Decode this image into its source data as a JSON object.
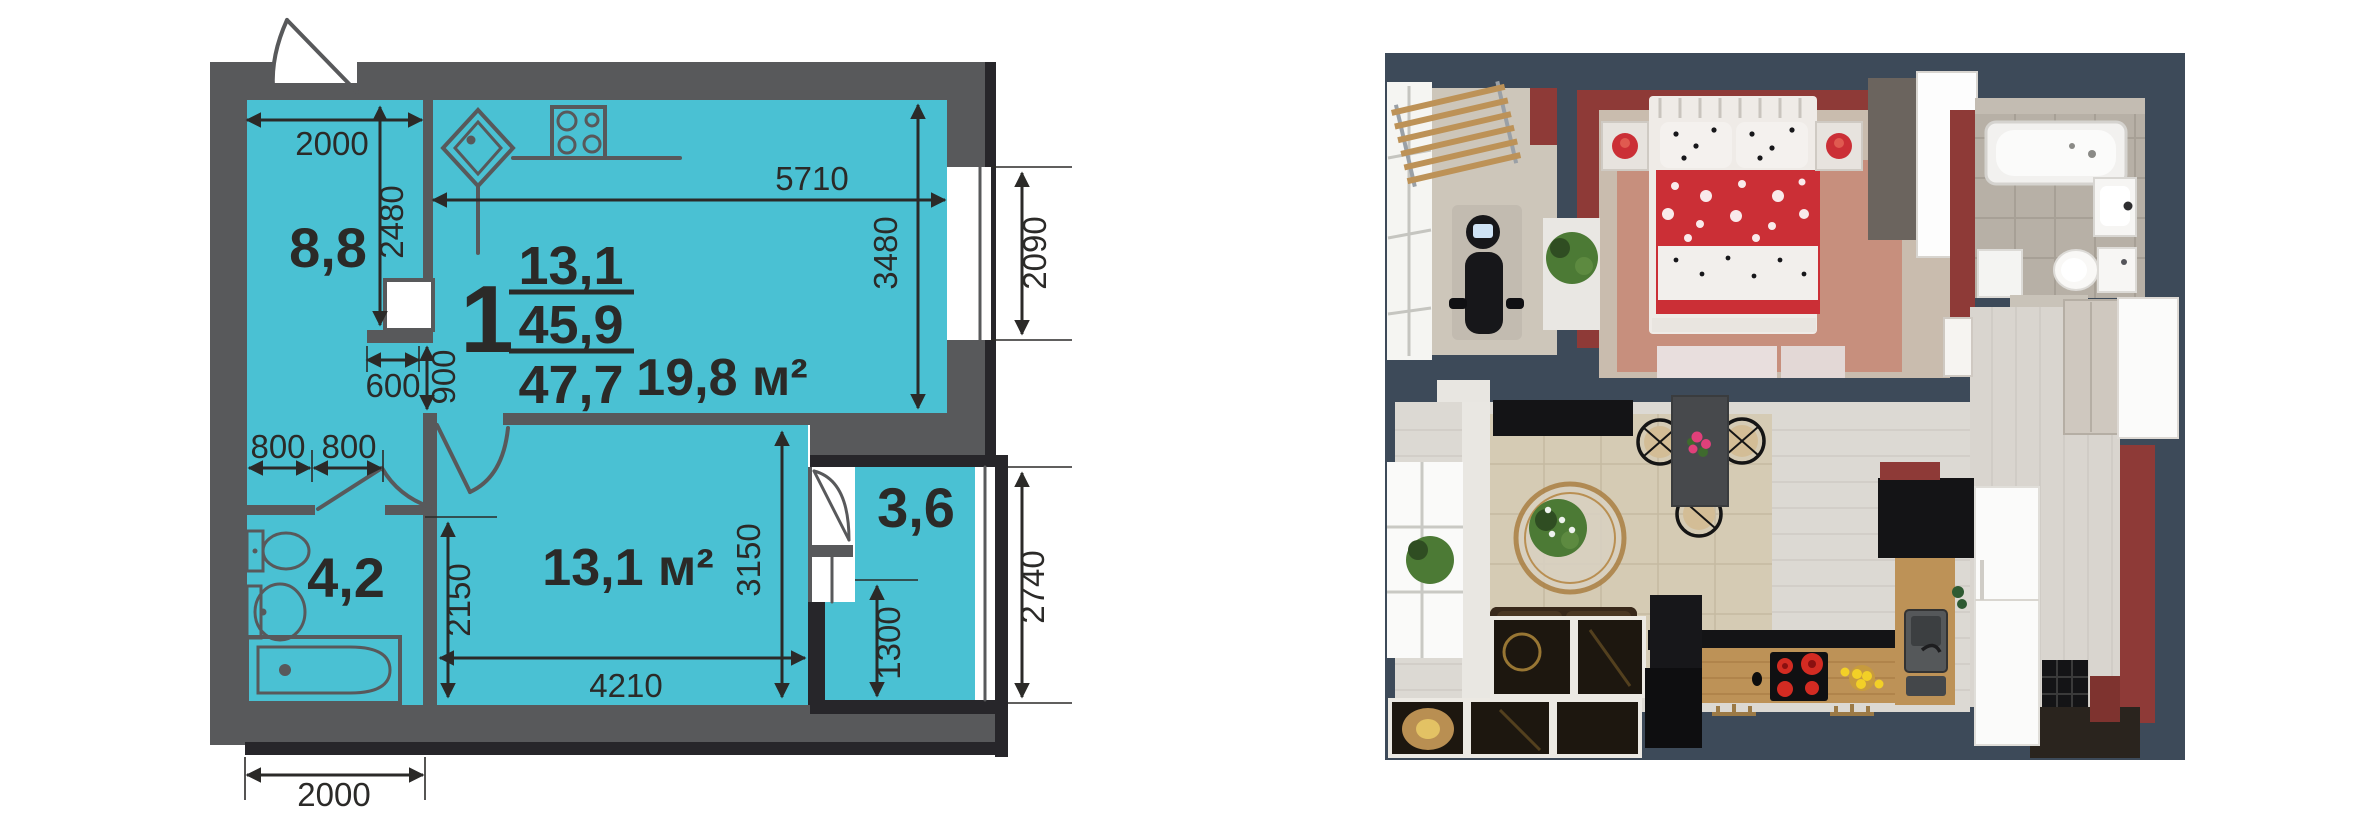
{
  "floor_plan": {
    "figure": "2d-floor-plan",
    "apartment": {
      "number": "1",
      "area_living": "13,1",
      "area_usable": "45,9",
      "area_total": "47,7"
    },
    "rooms": [
      {
        "id": "hall",
        "area_label": "8,8"
      },
      {
        "id": "kitchen_living",
        "area_label": "19,8 м²"
      },
      {
        "id": "bathroom",
        "area_label": "4,2"
      },
      {
        "id": "bedroom",
        "area_label": "13,1 м²"
      },
      {
        "id": "balcony",
        "area_label": "3,6"
      }
    ],
    "dimensions_mm": {
      "hall_width": "2000",
      "hall_depth": "2480",
      "kitchen_width": "5710",
      "kitchen_depth": "3480",
      "kitchen_window": "2090",
      "niche_width": "600",
      "passage": "900",
      "door_left": "800",
      "door_right": "800",
      "bedroom_depth_left": "2150",
      "bedroom_depth_right": "3150",
      "bedroom_width": "4210",
      "balcony_depth": "1300",
      "balcony_height": "2740",
      "bathroom_width": "2000"
    },
    "colors": {
      "room_fill": "#4ac1d3",
      "wall": "#58595b",
      "wall_dark": "#27262a",
      "ink": "#2b2a28",
      "paper": "#ffffff"
    }
  },
  "render_3d": {
    "figure": "3d-top-down-render",
    "colors": {
      "wall": "#3d4a59",
      "red": "#8e3a37",
      "duvet": "#cb2f36",
      "white": "#f7f6f3",
      "black": "#141416",
      "wood": "#bd9257",
      "floor": "#dcd9d3",
      "balcony_floor": "#cdc6ba",
      "bedroom_floor": "#c9bcae",
      "bedroom_rug": "#c78f7d",
      "living_marble": "#d5cbb4",
      "bath_tile": "#b7b0a6",
      "hall_floor": "#d9d5cf",
      "sofa": "#43311f",
      "gold": "#b98f52",
      "plant": "#4c7a35",
      "dark_tile": "#1d170f"
    }
  }
}
